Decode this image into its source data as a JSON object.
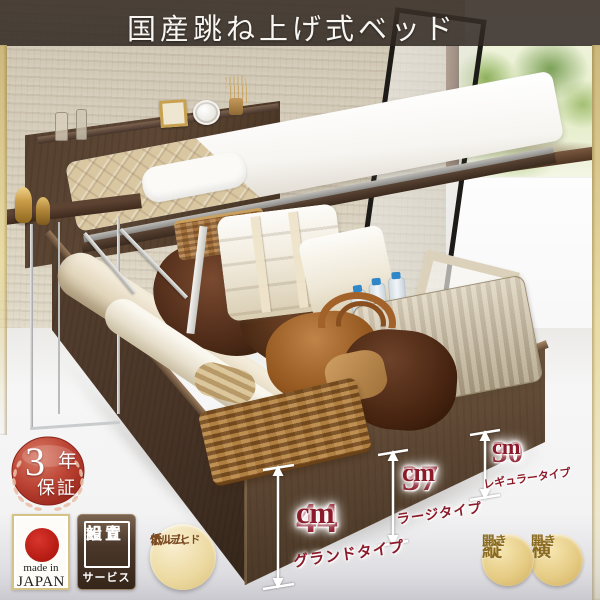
{
  "banner": {
    "title": "国産跳ね上げ式ベッド"
  },
  "badges": {
    "warranty": {
      "number": "3",
      "unit": "年",
      "label": "保証"
    },
    "made_in_japan": {
      "line1": "made in",
      "line2": "JAPAN"
    },
    "assembly": {
      "line1": "組立",
      "line2": "設置",
      "line3": "サービス"
    },
    "formaldehyde": {
      "line1": "低",
      "line2": "ホルム",
      "line3": "アルデヒド"
    }
  },
  "measurements": [
    {
      "number": "44",
      "unit": "cm",
      "label": "グランドタイプ"
    },
    {
      "number": "37",
      "unit": "cm",
      "label": "ラージタイプ"
    },
    {
      "number": "30",
      "unit": "cm",
      "label": "レギュラータイプ"
    }
  ],
  "opening_types": [
    {
      "main": "縦",
      "sub": "開き"
    },
    {
      "main": "横",
      "sub": "開き"
    }
  ],
  "colors": {
    "accent_red": "#8b1b2a",
    "warranty_red": "#bc4434",
    "gold": "#e6cc85",
    "wood_dark": "#4a3628",
    "banner_bg": "#3a322a"
  }
}
